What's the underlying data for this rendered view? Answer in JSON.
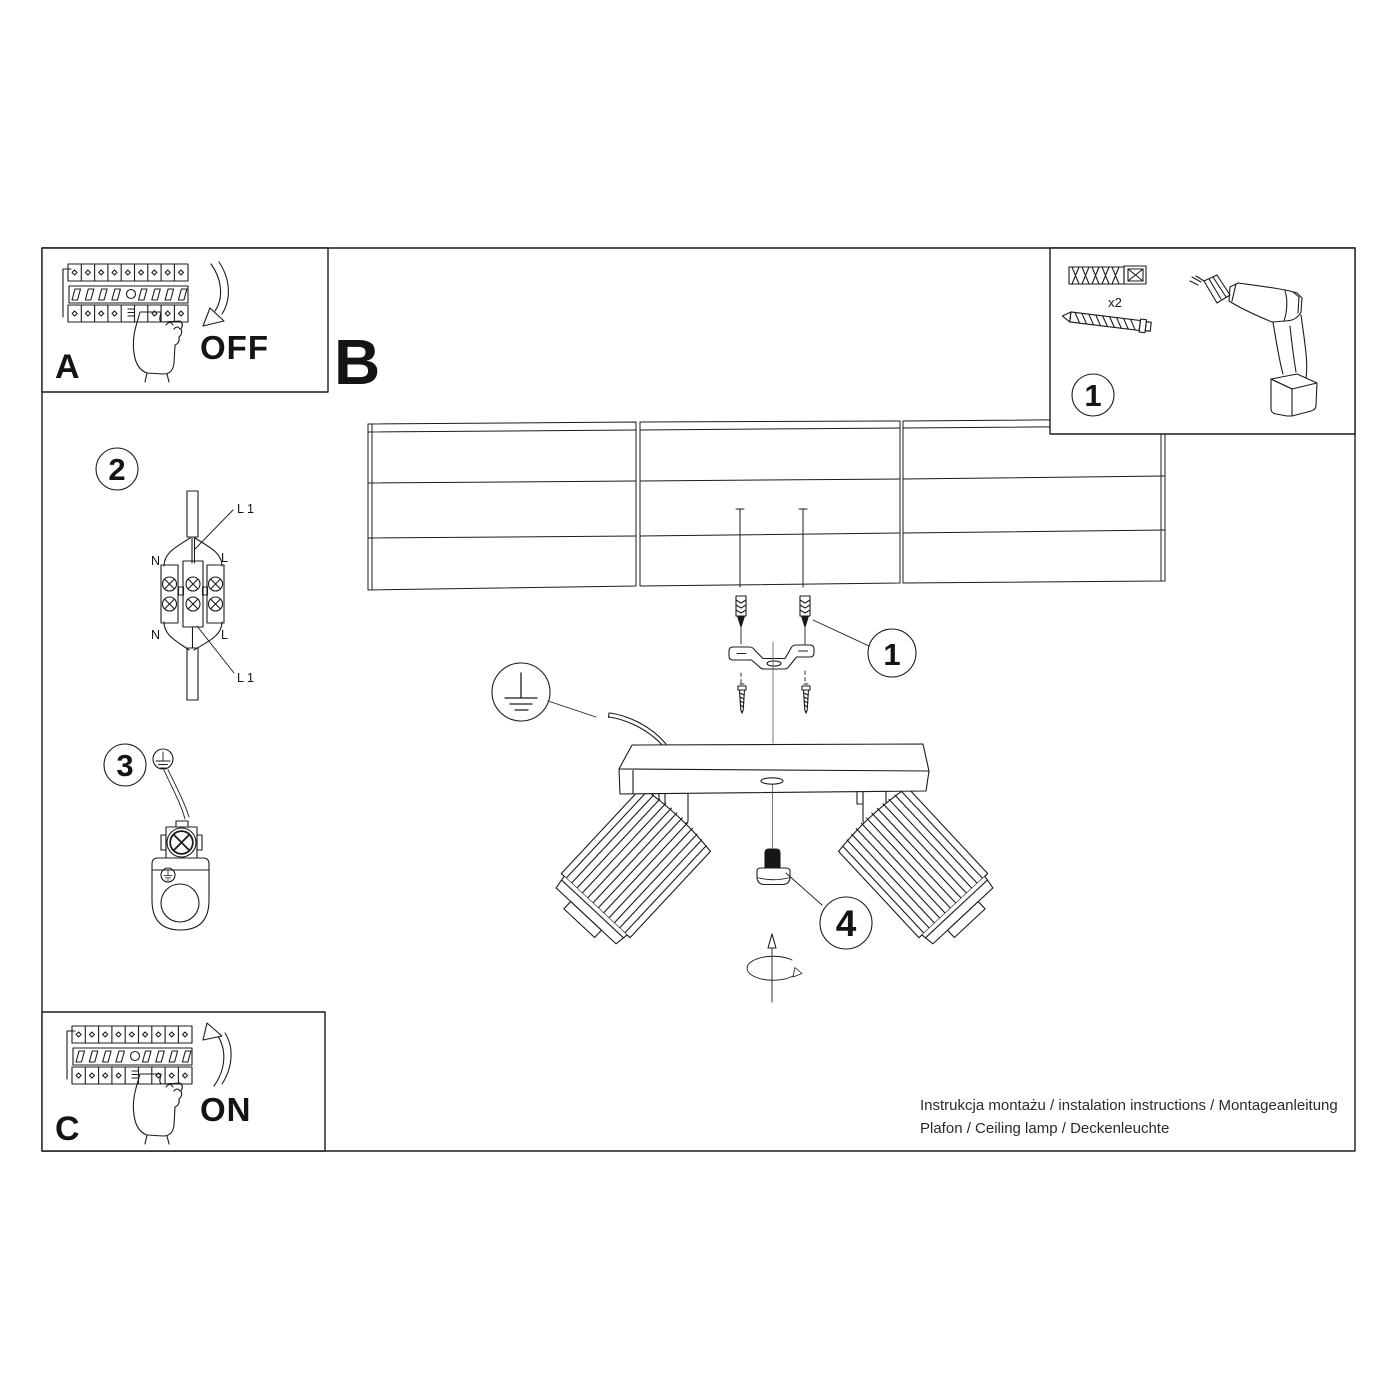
{
  "document": {
    "type": "installation-instruction-sheet",
    "colors": {
      "line": "#1c1c1c",
      "background": "#ffffff"
    }
  },
  "panel_a": {
    "letter": "A",
    "state": "OFF"
  },
  "panel_b": {
    "letter": "B"
  },
  "panel_c": {
    "letter": "C",
    "state": "ON"
  },
  "tools": {
    "badge": "1",
    "qty": "x2"
  },
  "steps": {
    "s2": "2",
    "s3": "3",
    "s4": "4"
  },
  "callouts": {
    "bracket": "1"
  },
  "wiring": {
    "n_top": "N",
    "l_top": "L",
    "n_bottom": "N",
    "l_bottom": "L",
    "l1_top": "L 1",
    "l1_bottom": "L 1"
  },
  "footer": {
    "line1": "Instrukcja montażu / instalation instructions / Montageanleitung",
    "line2": "Plafon / Ceiling lamp / Deckenleuchte"
  },
  "icons": [
    "circuit-breaker",
    "pointing-hand",
    "curved-arrow-down",
    "curved-arrow-up",
    "wall-plug",
    "screw",
    "cordless-drill",
    "terminal-block",
    "earth-symbol",
    "ceiling-planks",
    "mounting-bracket",
    "ceiling-lamp-two-spots",
    "thumb-screw",
    "rotation-arrow"
  ]
}
